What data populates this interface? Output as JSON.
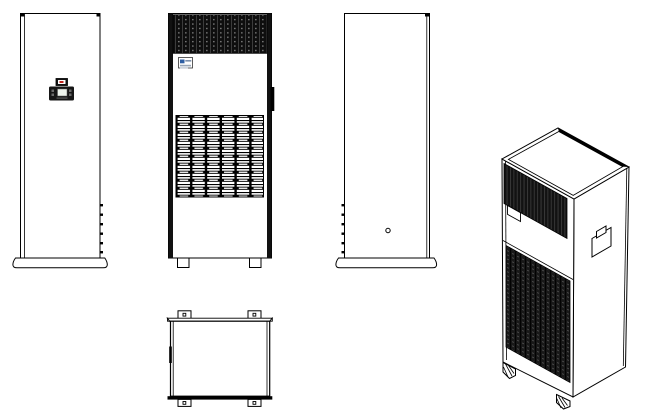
{
  "drawing": {
    "kind": "equipment-outline-drawing",
    "views": {
      "side_a": {
        "id": "side-view-a",
        "features": [
          "control-panel",
          "status-indicator",
          "lcd-display",
          "edge-vent-ticks",
          "base-plinth"
        ]
      },
      "front": {
        "id": "front-view",
        "features": [
          "top-air-grille",
          "brand-label",
          "door-handle",
          "louver-grille",
          "leveling-feet"
        ]
      },
      "side_b": {
        "id": "side-view-b",
        "features": [
          "screw-hole",
          "edge-vent-ticks",
          "base-plinth"
        ]
      },
      "top": {
        "id": "top-view",
        "features": [
          "mounting-brackets",
          "bracket-holes",
          "edge-rail"
        ]
      },
      "isometric": {
        "id": "isometric-view",
        "features": [
          "top-cover",
          "top-air-grille",
          "brand-label",
          "panel-seam",
          "louver-grille",
          "side-handle",
          "caster-feet"
        ]
      }
    }
  },
  "colors": {
    "background": "#ffffff",
    "line": "#000000",
    "grille_dark": "#0e0e0e",
    "indicator_red": "#c0251d",
    "logo_blue": "#2e5fa3",
    "lcd_green": "#eef3ec"
  }
}
